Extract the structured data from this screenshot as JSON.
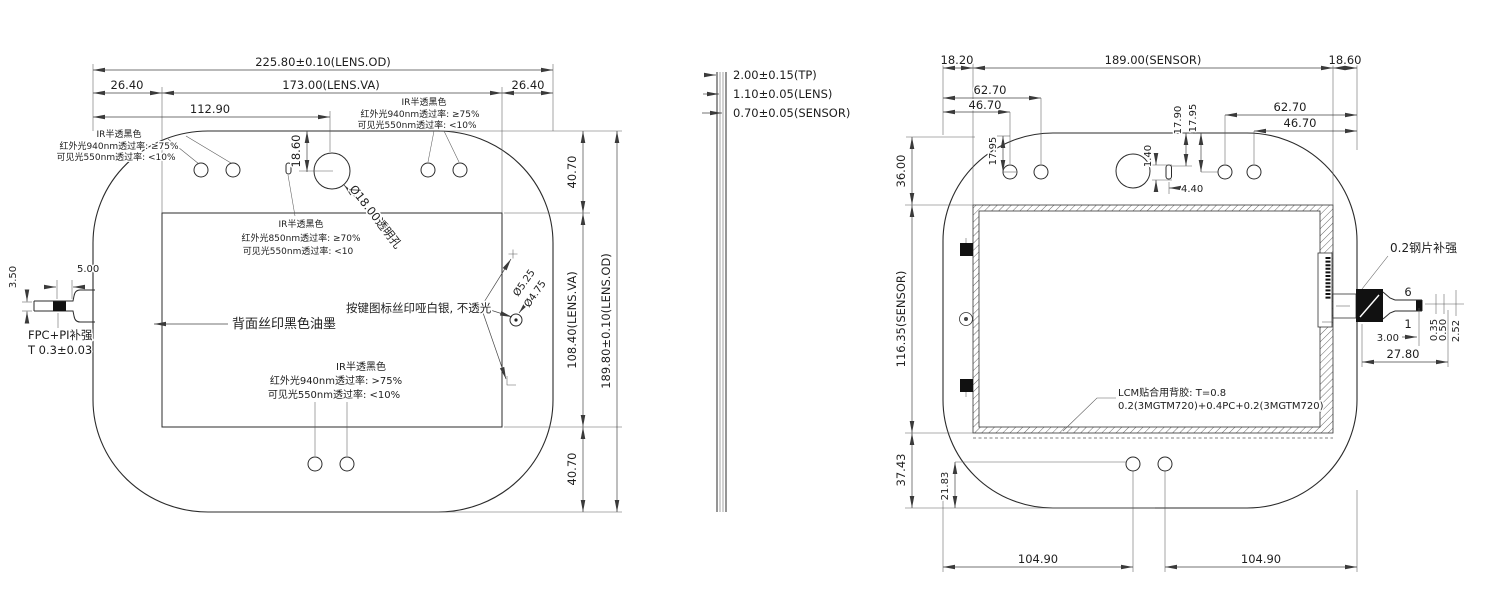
{
  "view_front": {
    "dims": {
      "od_w": "225.80±0.10(LENS.OD)",
      "va_w": "173.00(LENS.VA)",
      "margin_l": "26.40",
      "margin_r": "26.40",
      "hole_x": "112.90",
      "hole_y": "18.60",
      "ir_hole": "Ø18.00透明孔",
      "margin_t": "40.70",
      "va_h": "108.40(LENS.VA)",
      "margin_b": "40.70",
      "od_h": "189.80±0.10(LENS.OD)",
      "key_d_outer": "Ø5.25",
      "key_d_inner": "Ø4.75",
      "fpc_h": "3.50",
      "fpc_w": "5.00"
    },
    "notes": {
      "fpc_1": "FPC+PI补强",
      "fpc_2": "T 0.3±0.03",
      "back_ink": "背面丝印黑色油墨",
      "key_icon": "按键图标丝印哑白银, 不透光",
      "ir_top_left": [
        "IR半透黑色",
        "红外光940nm透过率: ≥75%",
        "可见光550nm透过率: <10%"
      ],
      "ir_top_right": [
        "IR半透黑色",
        "红外光940nm透过率: ≥75%",
        "可见光550nm透过率: <10%"
      ],
      "ir_center": [
        "IR半透黑色",
        "红外光850nm透过率: ≥70%",
        "可见光550nm透过率: <10"
      ],
      "ir_bottom": [
        "IR半透黑色",
        "红外光940nm透过率: >75%",
        "可见光550nm透过率: <10%"
      ]
    }
  },
  "view_profile": {
    "dims": [
      "2.00±0.15(TP)",
      "1.10±0.05(LENS)",
      "0.70±0.05(SENSOR)"
    ]
  },
  "view_back": {
    "dims": {
      "margin_l": "18.20",
      "sensor_w": "189.00(SENSOR)",
      "margin_r": "18.60",
      "hole_l_far": "62.70",
      "hole_l_near": "46.70",
      "hole_r_far": "62.70",
      "hole_r_near": "46.70",
      "hole_l_y": "17.95",
      "slot_y1": "17.90",
      "slot_y2": "17.95",
      "slot_h": "1.40",
      "slot_off": "4.40",
      "sensor_top": "36.00",
      "sensor_h": "116.35(SENSOR)",
      "corner_b": "37.43",
      "hole_b_y": "21.83",
      "hole_b_l": "104.90",
      "hole_b_r": "104.90",
      "fpc_len": "27.80",
      "fpc_end": "3.00",
      "fpc_t1": "0.35",
      "fpc_t2": "0.50",
      "fpc_t3": "2.52",
      "pin_first": "6",
      "pin_last": "1"
    },
    "notes": {
      "steel": "0.2钢片补强",
      "lcm_1": "LCM贴合用背胶: T=0.8",
      "lcm_2": "0.2(3MGTM720)+0.4PC+0.2(3MGTM720)"
    }
  }
}
